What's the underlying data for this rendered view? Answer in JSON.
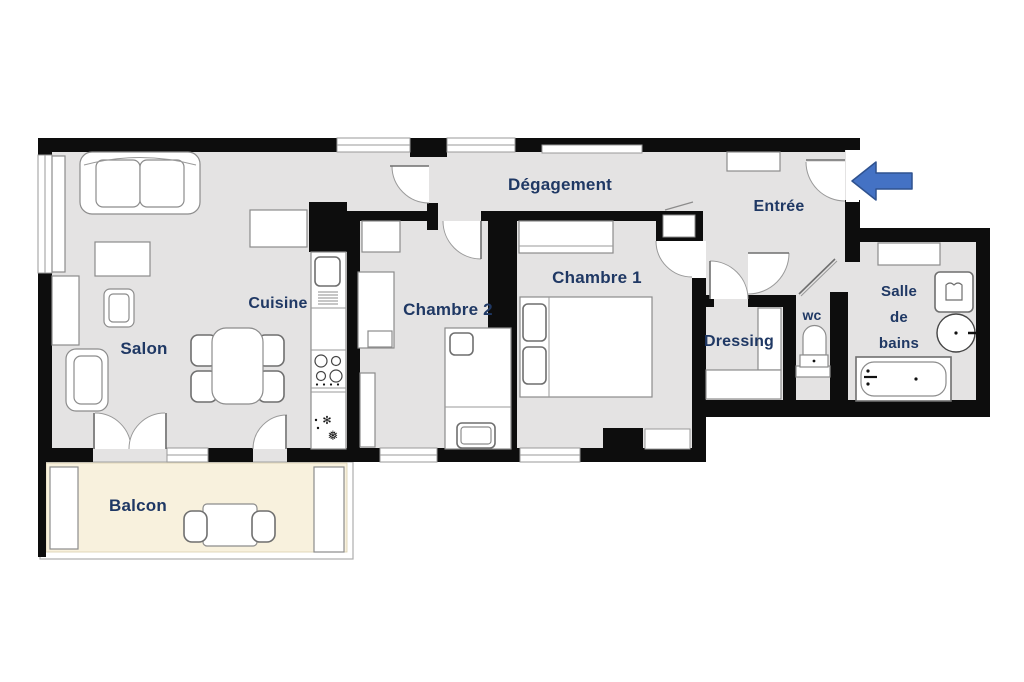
{
  "plan": {
    "labels": {
      "salon": "Salon",
      "cuisine": "Cuisine",
      "chambre2": "Chambre 2",
      "chambre1": "Chambre 1",
      "degagement": "Dégagement",
      "entree": "Entrée",
      "dressing": "Dressing",
      "wc": "wc",
      "salle_de_bains": {
        "line1": "Salle",
        "line2": "de",
        "line3": "bains"
      },
      "balcon": "Balcon"
    },
    "colors": {
      "wall": "#0d0d0d",
      "floor": "#e4e3e3",
      "balcony_floor": "#f8f1dd",
      "label_text": "#1f3864",
      "arrow_fill": "#4472c4",
      "arrow_border": "#2f528f"
    },
    "icons": {
      "entrance_arrow": "left-arrow",
      "fridge_snowflake": "❅",
      "fridge_snowflake_small": "✻"
    }
  }
}
